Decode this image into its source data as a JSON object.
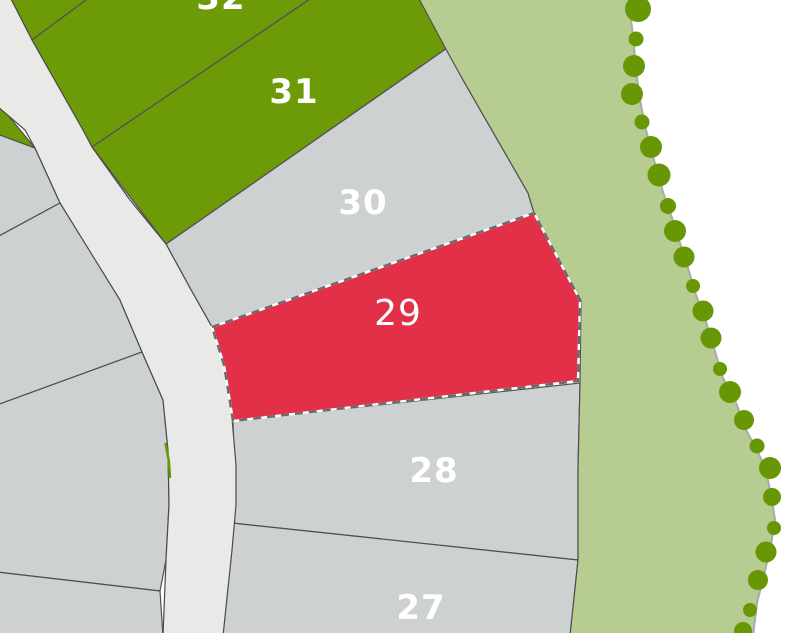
{
  "map": {
    "title": "Residential subdivision plat map",
    "selected_lot": "29",
    "lots": [
      {
        "id": "lot-32",
        "label": "32",
        "status": "green"
      },
      {
        "id": "lot-31",
        "label": "31",
        "status": "green"
      },
      {
        "id": "lot-30",
        "label": "30",
        "status": "standard"
      },
      {
        "id": "lot-29",
        "label": "29",
        "status": "selected"
      },
      {
        "id": "lot-28",
        "label": "28",
        "status": "standard"
      },
      {
        "id": "lot-27",
        "label": "27",
        "status": "standard"
      }
    ],
    "colors": {
      "background_white": "#ffffff",
      "lot_gray": "#cdd1d1",
      "lot_green": "#6d9a07",
      "lot_selected_red": "#e23049",
      "road_gray": "#e9e9e8",
      "woodland_green": "#b7cc90",
      "tree_green": "#689706",
      "label_text": "#ffffff"
    }
  }
}
